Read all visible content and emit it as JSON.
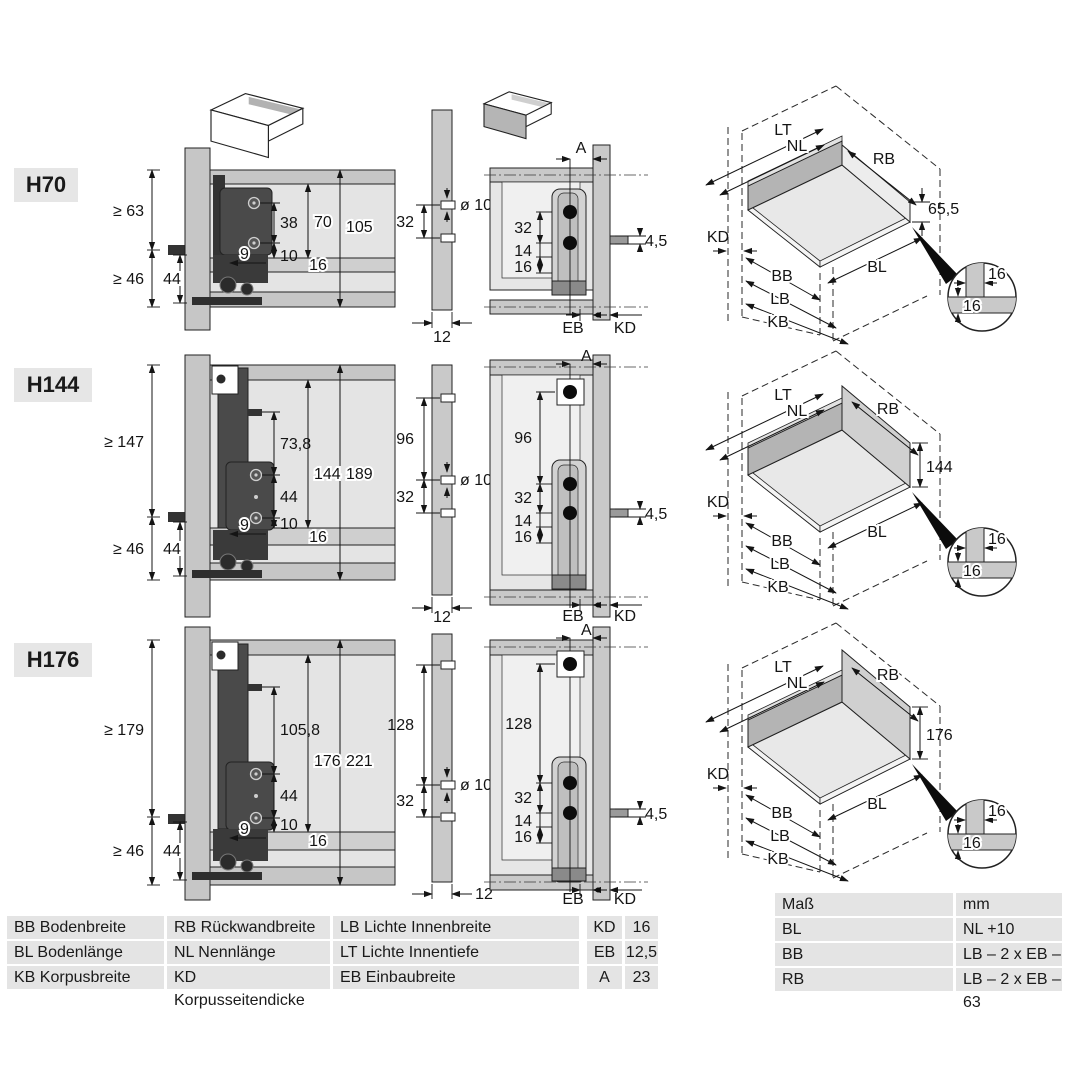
{
  "rows": [
    {
      "label": "H70",
      "side": {
        "min_top": "≥ 63",
        "min_bottom": "≥ 46",
        "front_gap": "44",
        "hole_span": "38",
        "to_bottom": "10",
        "offset": "9",
        "inner_height": "70",
        "outer_height": "105",
        "bottom_thickness": "16"
      },
      "drill": {
        "pitch": "32",
        "diameter": "ø 10",
        "thickness": "12"
      },
      "rear": {
        "a": "A",
        "pitch": "32",
        "d14": "14",
        "d16": "16",
        "pin": "4,5",
        "eb": "EB",
        "kd": "KD"
      },
      "iso": {
        "lt": "LT",
        "nl": "NL",
        "rb": "RB",
        "kd": "KD",
        "bb": "BB",
        "lb": "LB",
        "kb": "KB",
        "bl": "BL",
        "back_height": "65,5",
        "detail_top": "16",
        "detail_bottom": "16"
      }
    },
    {
      "label": "H144",
      "side": {
        "min_top": "≥ 147",
        "min_bottom": "≥ 46",
        "front_gap": "44",
        "pin_span": "73,8",
        "hole_span": "44",
        "to_bottom": "10",
        "offset": "9",
        "inner_height": "144",
        "outer_height": "189",
        "bottom_thickness": "16"
      },
      "drill": {
        "pitch_upper": "96",
        "pitch": "32",
        "diameter": "ø 10",
        "thickness": "12"
      },
      "rear": {
        "a": "A",
        "pitch_upper": "96",
        "pitch": "32",
        "d14": "14",
        "d16": "16",
        "pin": "4,5",
        "eb": "EB",
        "kd": "KD"
      },
      "iso": {
        "lt": "LT",
        "nl": "NL",
        "rb": "RB",
        "kd": "KD",
        "bb": "BB",
        "lb": "LB",
        "kb": "KB",
        "bl": "BL",
        "back_height": "144",
        "detail_top": "16",
        "detail_bottom": "16"
      }
    },
    {
      "label": "H176",
      "side": {
        "min_top": "≥ 179",
        "min_bottom": "≥ 46",
        "front_gap": "44",
        "pin_span": "105,8",
        "hole_span": "44",
        "to_bottom": "10",
        "offset": "9",
        "inner_height": "176",
        "outer_height": "221",
        "bottom_thickness": "16"
      },
      "drill": {
        "pitch_upper": "128",
        "pitch": "32",
        "diameter": "ø 10",
        "thickness": "12"
      },
      "rear": {
        "a": "A",
        "pitch_upper": "128",
        "pitch": "32",
        "d14": "14",
        "d16": "16",
        "pin": "4,5",
        "eb": "EB",
        "kd": "KD"
      },
      "iso": {
        "lt": "LT",
        "nl": "NL",
        "rb": "RB",
        "kd": "KD",
        "bb": "BB",
        "lb": "LB",
        "kb": "KB",
        "bl": "BL",
        "back_height": "176",
        "detail_top": "16",
        "detail_bottom": "16"
      }
    }
  ],
  "legend_table": {
    "rows": [
      [
        "BB Bodenbreite",
        "RB Rückwandbreite",
        "LB Lichte Innenbreite"
      ],
      [
        "BL Bodenlänge",
        "NL Nennlänge",
        "LT Lichte Innentiefe"
      ],
      [
        "KB Korpusbreite",
        "KD Korpusseitendicke",
        "EB Einbaubreite"
      ]
    ]
  },
  "values_table": {
    "rows": [
      [
        "KD",
        "16"
      ],
      [
        "EB",
        "12,5"
      ],
      [
        "A",
        "23"
      ]
    ]
  },
  "formula_table": {
    "header": [
      "Maß",
      "mm"
    ],
    "rows": [
      [
        "BL",
        "NL +10"
      ],
      [
        "BB",
        "LB – 2 x EB – 51,5"
      ],
      [
        "RB",
        "LB – 2 x EB – 63"
      ]
    ]
  }
}
